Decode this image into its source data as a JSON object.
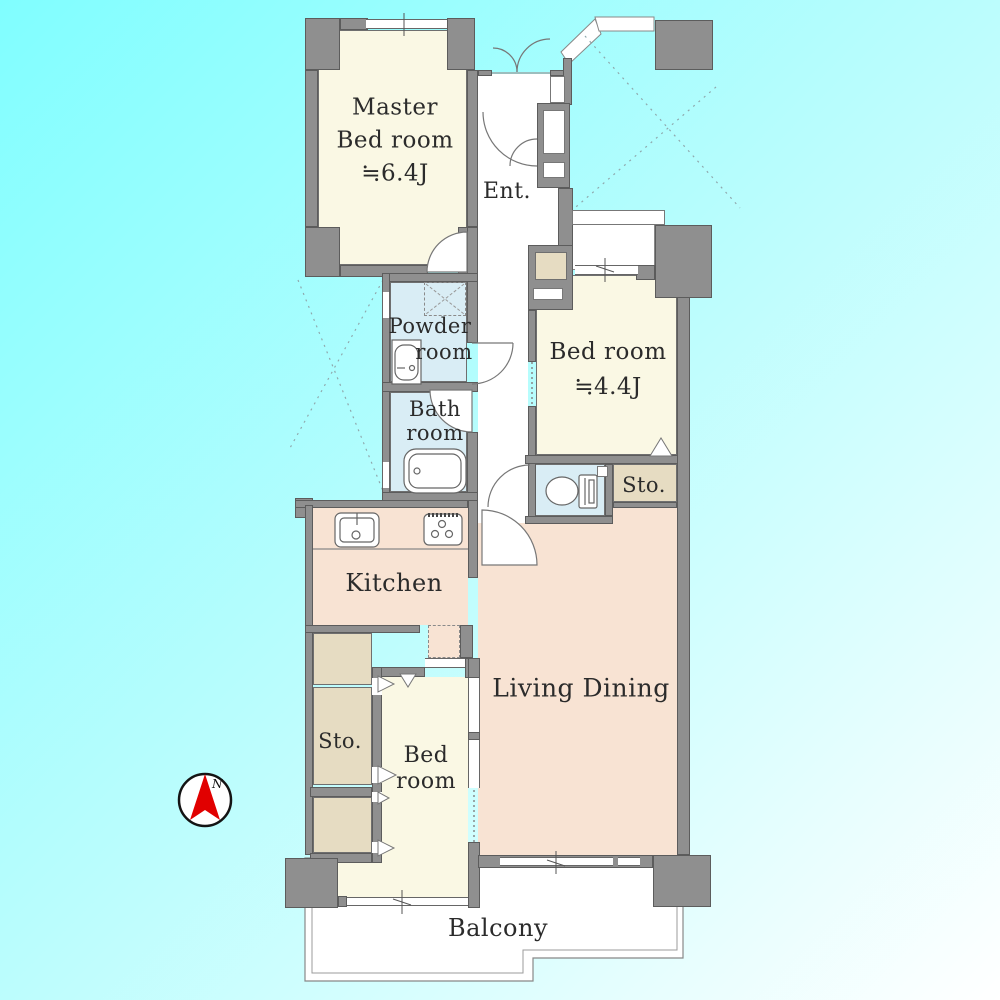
{
  "plan": {
    "rooms": {
      "master_bedroom": {
        "lines": [
          "Master",
          "Bed room",
          "≒6.4J"
        ]
      },
      "entrance": {
        "label": "Ent."
      },
      "powder_room": {
        "line1": "Powder",
        "line2": "room"
      },
      "bath_room": {
        "lines": [
          "Bath",
          "room"
        ]
      },
      "bedroom_2": {
        "lines": [
          "Bed room",
          "≒4.4J"
        ]
      },
      "storage_1": {
        "label": "Sto."
      },
      "kitchen": {
        "label": "Kitchen"
      },
      "living_dining": {
        "label": "Living Dining"
      },
      "bedroom_3": {
        "lines": [
          "Bed",
          "room"
        ]
      },
      "storage_2": {
        "label": "Sto."
      },
      "balcony": {
        "label": "Balcony"
      }
    },
    "compass": {
      "north_label": "N"
    },
    "colors": {
      "background_gradient_start": "#80feff",
      "background_gradient_end": "#ffffff",
      "wall_gray": "#8f8f8f",
      "room_cream": "#faf8e4",
      "room_wet_blue": "#d9edf5",
      "room_storage_tan": "#e6dcc2",
      "room_living_peach": "#f8e3d3",
      "balcony_white": "#ffffff",
      "compass_red": "#e10000",
      "label_text": "#2b2b2b"
    }
  }
}
